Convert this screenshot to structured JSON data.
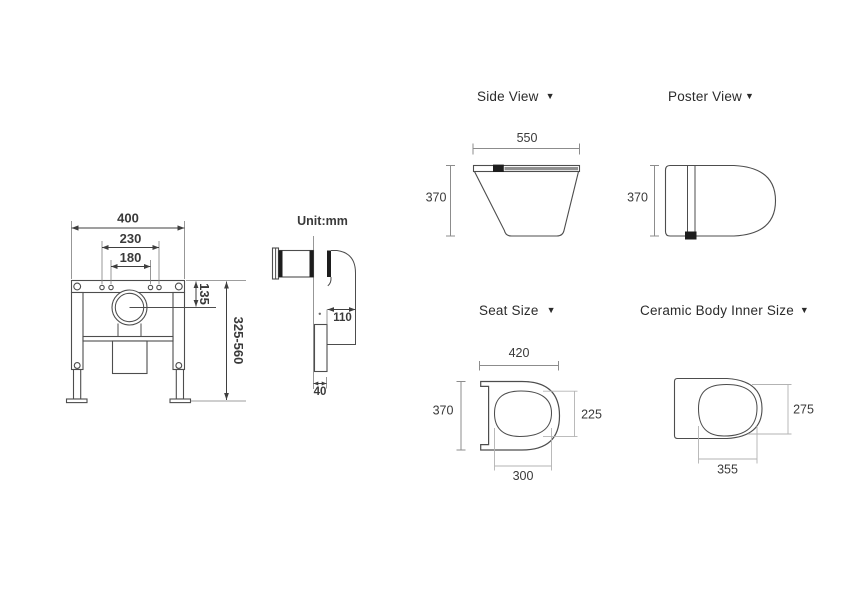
{
  "colors": {
    "background": "#ffffff",
    "line": "#4d4d4d",
    "dimension_line": "#8c8c8c",
    "light_dimension_line": "#b3b3b3",
    "text": "#3a3a3a",
    "marker": "#1d1d1d"
  },
  "unit_note": "Unit:mm",
  "caret_icon": "▼",
  "frame_diagram": {
    "width": "400",
    "bolt_span_outer": "230",
    "bolt_span_inner": "180",
    "outlet_drop": "135",
    "height_range": "325-560"
  },
  "pipe_diagram": {
    "outlet_offset": "110",
    "flush_pipe_width": "40"
  },
  "side_view": {
    "title": "Side View",
    "depth": "550",
    "height": "370"
  },
  "poster_view": {
    "title": "Poster View",
    "width": "370"
  },
  "seat_size": {
    "title": "Seat Size",
    "width": "420",
    "depth": "370",
    "inner_depth": "225",
    "inner_width": "300"
  },
  "ceramic_inner_size": {
    "title": "Ceramic Body Inner Size",
    "inner_depth": "275",
    "inner_width": "355"
  }
}
